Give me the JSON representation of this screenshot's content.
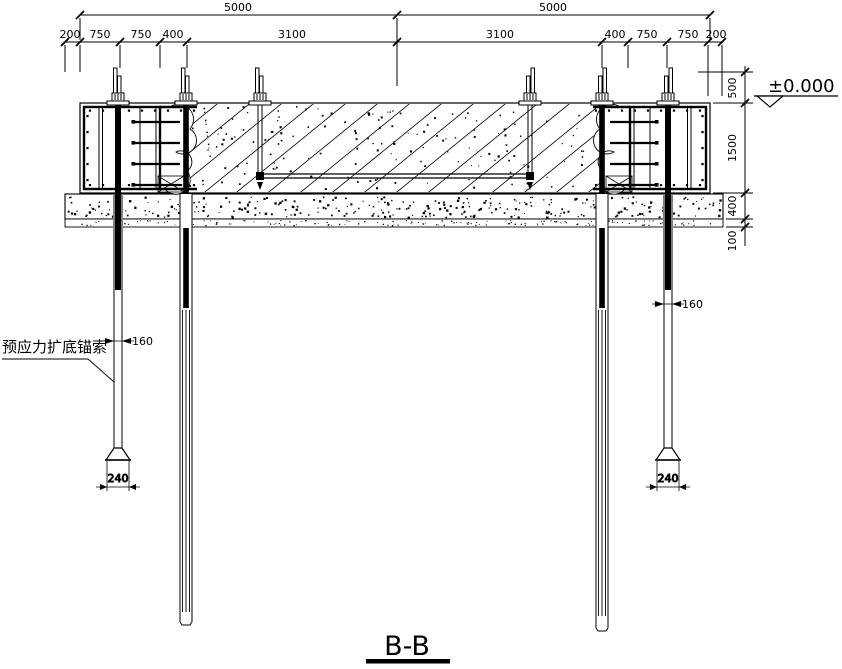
{
  "section": {
    "title": "B-B"
  },
  "elevation": {
    "label": "±0.000"
  },
  "annotations": {
    "anchor_cable_label": "预应力扩底锚索",
    "dia_left": "160",
    "dia_right": "160",
    "base_left": "240",
    "base_right": "240"
  },
  "dimensions": {
    "top_row": [
      "5000",
      "5000"
    ],
    "second_row": [
      "200",
      "750",
      "750",
      "400",
      "3100",
      "3100",
      "400",
      "750",
      "750",
      "200"
    ],
    "right_column": [
      "500",
      "1500",
      "400",
      "100"
    ]
  },
  "colors": {
    "line": "#000000",
    "background": "#ffffff"
  }
}
